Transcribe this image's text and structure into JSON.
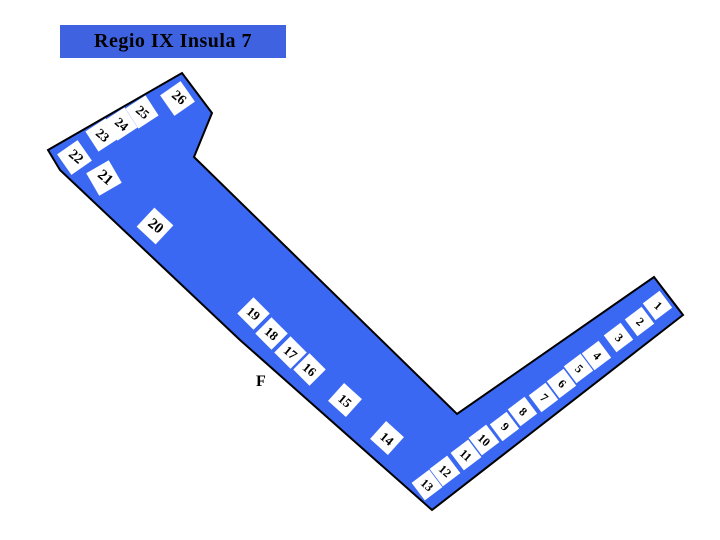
{
  "title": "Regio IX Insula 7",
  "colors": {
    "background": "#ffffff",
    "title_bg": "#3f63e0",
    "shape_fill": "#3a68f2",
    "shape_outline": "#000000",
    "box_fill": "#ffffff",
    "text": "#000000"
  },
  "map": {
    "outline_points": "48,150 182,73 212,113 194,157 457,414 654,277 683,315 432,510 240,340 60,170",
    "street_label": "F",
    "boxes": [
      {
        "n": "1",
        "x": 657,
        "y": 305,
        "r": -37,
        "tr": 79,
        "s": 21
      },
      {
        "n": "2",
        "x": 639,
        "y": 321,
        "r": -37,
        "tr": 79,
        "s": 21
      },
      {
        "n": "3",
        "x": 618,
        "y": 337,
        "r": -37,
        "tr": 79,
        "s": 21
      },
      {
        "n": "4",
        "x": 596,
        "y": 355,
        "r": -37,
        "tr": 79,
        "s": 21
      },
      {
        "n": "5",
        "x": 578,
        "y": 368,
        "r": -37,
        "tr": 79,
        "s": 21
      },
      {
        "n": "6",
        "x": 561,
        "y": 383,
        "r": -37,
        "tr": 79,
        "s": 21
      },
      {
        "n": "7",
        "x": 543,
        "y": 397,
        "r": -37,
        "tr": 79,
        "s": 21
      },
      {
        "n": "8",
        "x": 522,
        "y": 411,
        "r": -37,
        "tr": 79,
        "s": 21
      },
      {
        "n": "9",
        "x": 504,
        "y": 426,
        "r": -37,
        "tr": 79,
        "s": 21
      },
      {
        "n": "10",
        "x": 484,
        "y": 440,
        "r": -37,
        "tr": 79,
        "s": 22
      },
      {
        "n": "11",
        "x": 466,
        "y": 455,
        "r": -37,
        "tr": 79,
        "s": 22
      },
      {
        "n": "12",
        "x": 445,
        "y": 471,
        "r": -37,
        "tr": 79,
        "s": 22
      },
      {
        "n": "13",
        "x": 427,
        "y": 485,
        "r": -37,
        "tr": 79,
        "s": 22
      },
      {
        "n": "14",
        "x": 387,
        "y": 438,
        "r": 42,
        "tr": -2,
        "s": 24
      },
      {
        "n": "15",
        "x": 345,
        "y": 400,
        "r": 42,
        "tr": -2,
        "s": 24
      },
      {
        "n": "16",
        "x": 309,
        "y": 369,
        "r": 45,
        "tr": -5,
        "s": 23
      },
      {
        "n": "17",
        "x": 290,
        "y": 352,
        "r": 45,
        "tr": -5,
        "s": 23
      },
      {
        "n": "18",
        "x": 271,
        "y": 333,
        "r": 45,
        "tr": -5,
        "s": 23
      },
      {
        "n": "19",
        "x": 253,
        "y": 313,
        "r": 45,
        "tr": -5,
        "s": 23
      },
      {
        "n": "20",
        "x": 155,
        "y": 226,
        "r": 43,
        "tr": -4,
        "s": 26
      },
      {
        "n": "21",
        "x": 104,
        "y": 178,
        "r": -30,
        "tr": 70,
        "s": 26
      },
      {
        "n": "22",
        "x": 74,
        "y": 157,
        "r": -35,
        "tr": 75,
        "s": 25
      },
      {
        "n": "23",
        "x": 102,
        "y": 135,
        "r": -33,
        "tr": 73,
        "s": 24
      },
      {
        "n": "24",
        "x": 121,
        "y": 124,
        "r": -33,
        "tr": 73,
        "s": 24
      },
      {
        "n": "25",
        "x": 142,
        "y": 112,
        "r": -33,
        "tr": 73,
        "s": 24
      },
      {
        "n": "26",
        "x": 177,
        "y": 98,
        "r": -35,
        "tr": 75,
        "s": 25
      }
    ]
  }
}
